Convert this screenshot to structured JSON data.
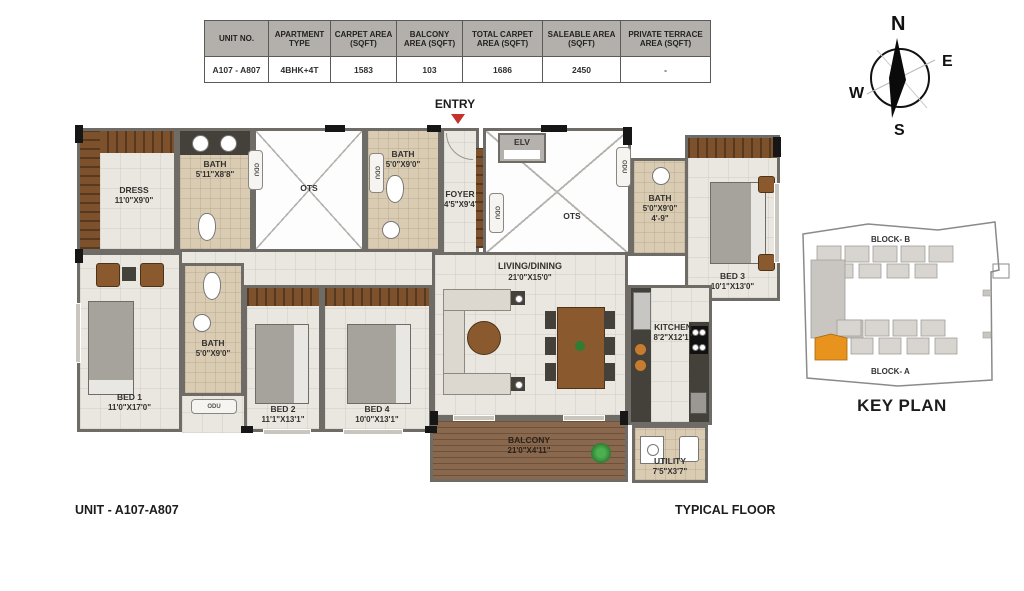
{
  "table": {
    "headers": [
      "UNIT NO.",
      "APARTMENT TYPE",
      "CARPET AREA (SQFT)",
      "BALCONY AREA (SQFT)",
      "TOTAL CARPET AREA (SQFT)",
      "SALEABLE AREA (SQFT)",
      "PRIVATE TERRACE AREA (SQFT)"
    ],
    "row": [
      "A107 - A807",
      "4BHK+4T",
      "1583",
      "103",
      "1686",
      "2450",
      "-"
    ]
  },
  "entry": {
    "label": "ENTRY"
  },
  "compass": {
    "north": "N",
    "east": "E",
    "south": "S",
    "west": "W"
  },
  "floorplan": {
    "rooms": {
      "dress": {
        "label": "DRESS",
        "dim": "11'0\"X9'0\""
      },
      "bath_dress": {
        "label": "BATH",
        "dim": "5'11\"X8'8\""
      },
      "ots_left": {
        "label": "OTS"
      },
      "bath_top": {
        "label": "BATH",
        "dim": "5'0\"X9'0\""
      },
      "foyer": {
        "label": "FOYER",
        "dim": "4'5\"X9'4\""
      },
      "elv": {
        "label": "ELV"
      },
      "ots_right": {
        "label": "OTS"
      },
      "bath_bed3": {
        "label": "BATH",
        "dim": "5'0\"X9'0\"",
        "note": "4'-9\""
      },
      "bed3": {
        "label": "BED 3",
        "dim": "10'1\"X13'0\""
      },
      "living": {
        "label": "LIVING/DINING",
        "dim": "21'0\"X15'0\""
      },
      "kitchen": {
        "label": "KITCHEN",
        "dim": "8'2\"X12'1\""
      },
      "bed1": {
        "label": "BED 1",
        "dim": "11'0\"X17'0\""
      },
      "bath_bed1": {
        "label": "BATH",
        "dim": "5'0\"X9'0\""
      },
      "bed2": {
        "label": "BED 2",
        "dim": "11'1\"X13'1\""
      },
      "bed4": {
        "label": "BED 4",
        "dim": "10'0\"X13'1\""
      },
      "balcony": {
        "label": "BALCONY",
        "dim": "21'0\"X4'11\""
      },
      "utility": {
        "label": "UTILITY",
        "dim": "7'5\"X3'7\""
      }
    },
    "shaft": {
      "odu": "ODU"
    }
  },
  "keyplan": {
    "block_b": "BLOCK- B",
    "block_a": "BLOCK- A",
    "title": "KEY PLAN"
  },
  "footer": {
    "left": "UNIT - A107-A807",
    "right": "TYPICAL FLOOR"
  },
  "colors": {
    "accent_orange": "#e8931d",
    "entry_marker_red": "#c4322b",
    "wall_gray": "#6f6b66",
    "floor_cream": "#eae7e0",
    "bath_tan": "#d9ccb3",
    "wood_brown": "#7c512c",
    "balcony_brown": "#8a684e",
    "table_header_gray": "#b3b0ab"
  }
}
